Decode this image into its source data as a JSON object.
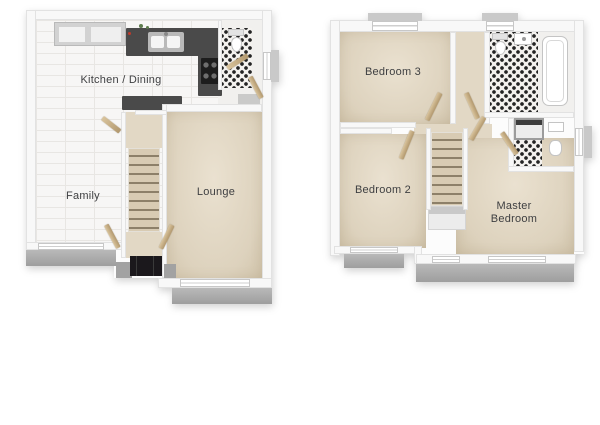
{
  "floor_plan": {
    "ground_floor": {
      "rooms": {
        "kitchen_dining": "Kitchen / Dining",
        "family": "Family",
        "lounge": "Lounge"
      }
    },
    "first_floor": {
      "rooms": {
        "bedroom3": "Bedroom 3",
        "bedroom2": "Bedroom 2",
        "master": "Master Bedroom"
      }
    }
  },
  "colors": {
    "background": "#ffffff",
    "carpet_beige": "#ddd2bd",
    "tile_white": "#f7f6f5",
    "mosaic_black": "#242424",
    "kitchen_counter": "#4a4a4a",
    "wood_door": "#c5ac83",
    "window_sill_gray": "#a6a6a6",
    "front_door": "#1b181c",
    "label_text": "#3e3f41"
  }
}
